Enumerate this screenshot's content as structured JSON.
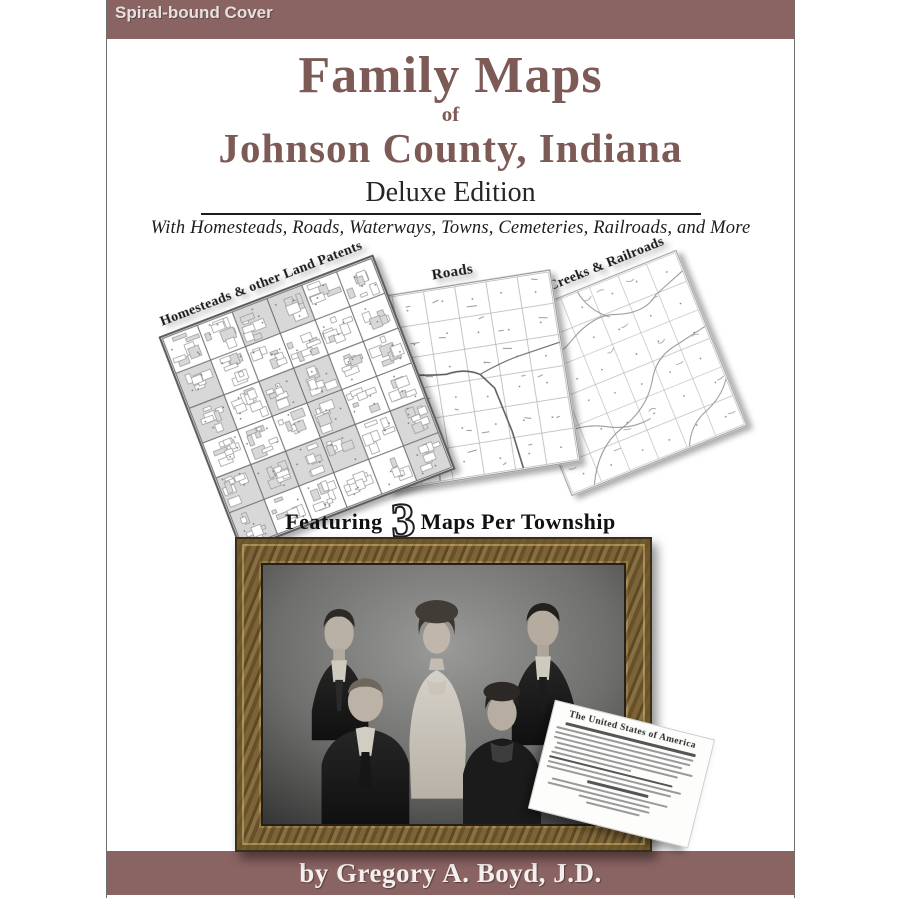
{
  "banner": {
    "label": "Spiral-bound Cover"
  },
  "title": {
    "line1": "Family Maps",
    "of": "of",
    "line2": "Johnson County, Indiana",
    "edition": "Deluxe Edition",
    "subtitle": "With Homesteads, Roads, Waterways, Towns, Cemeteries, Railroads, and More"
  },
  "maps": [
    {
      "label": "Homesteads & other Land Patents"
    },
    {
      "label": "Roads"
    },
    {
      "label": "Rivers, Creeks & Railroads"
    }
  ],
  "featuring": {
    "prefix": "Featuring",
    "number": "3",
    "suffix": "Maps Per Township"
  },
  "document": {
    "header": "The United States of America"
  },
  "author": {
    "label": "by Gregory A. Boyd, J.D."
  },
  "colors": {
    "banner_bg": "#8a6462",
    "title_color": "#7d5a56",
    "rule_color": "#1b1b1b",
    "parcel_gray": "#d8d8d8",
    "frame_wood": "#8a6f3e"
  }
}
